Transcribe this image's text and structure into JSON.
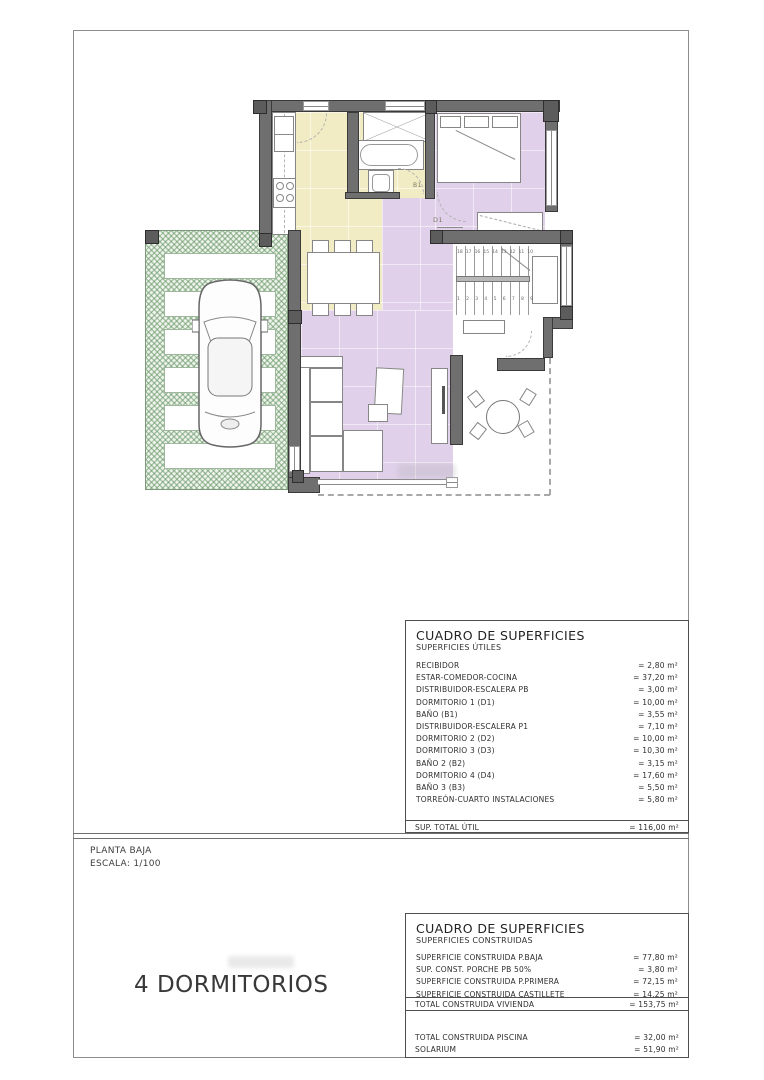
{
  "plan": {
    "labels": {
      "bath": "B1",
      "bedroom": "D1"
    },
    "stairs": {
      "top_numbers": [
        "18",
        "17",
        "16",
        "15",
        "14",
        "13",
        "12",
        "11",
        "10"
      ],
      "bottom_numbers": [
        "1",
        "2",
        "3",
        "4",
        "5",
        "6",
        "7",
        "8",
        "9"
      ]
    }
  },
  "caption": {
    "line1": "PLANTA BAJA",
    "line2": "ESCALA: 1/100"
  },
  "bedrooms_label": "4 DORMITORIOS",
  "tables": {
    "utiles": {
      "title": "CUADRO DE SUPERFICIES",
      "subtitle": "SUPERFICIES ÚTILES",
      "rows": [
        {
          "label": "RECIBIDOR",
          "value": "= 2,80 m²"
        },
        {
          "label": "ESTAR-COMEDOR-COCINA",
          "value": "= 37,20 m²"
        },
        {
          "label": "DISTRIBUIDOR-ESCALERA PB",
          "value": "= 3,00 m²"
        },
        {
          "label": "DORMITORIO 1 (D1)",
          "value": "= 10,00 m²"
        },
        {
          "label": "BAÑO (B1)",
          "value": "= 3,55 m²"
        },
        {
          "label": "DISTRIBUIDOR-ESCALERA P1",
          "value": "= 7,10 m²"
        },
        {
          "label": "DORMITORIO 2 (D2)",
          "value": "= 10,00 m²"
        },
        {
          "label": "DORMITORIO 3 (D3)",
          "value": "= 10,30 m²"
        },
        {
          "label": "BAÑO 2 (B2)",
          "value": "= 3,15 m²"
        },
        {
          "label": "DORMITORIO 4 (D4)",
          "value": "= 17,60 m²"
        },
        {
          "label": "BAÑO 3 (B3)",
          "value": "= 5,50 m²"
        },
        {
          "label": "TORREÓN-CUARTO INSTALACIONES",
          "value": "= 5,80 m²"
        }
      ],
      "total": {
        "label": "SUP. TOTAL ÚTIL",
        "value": "= 116,00 m²"
      }
    },
    "construidas": {
      "title": "CUADRO DE SUPERFICIES",
      "subtitle": "SUPERFICIES CONSTRUIDAS",
      "rows": [
        {
          "label": "SUPERFICIE CONSTRUIDA P.BAJA",
          "value": "= 77,80 m²"
        },
        {
          "label": "SUP. CONST. PORCHE PB 50%",
          "value": "= 3,80 m²"
        },
        {
          "label": "SUPERFICIE CONSTRUIDA P.PRIMERA",
          "value": "= 72,15 m²"
        },
        {
          "label": "SUPERFICIE CONSTRUIDA CASTILLETE",
          "value": "= 14,25 m²"
        }
      ],
      "total": {
        "label": "TOTAL CONSTRUIDA VIVIENDA",
        "value": "= 153,75 m²"
      },
      "extra_rows": [
        {
          "label": "TOTAL CONSTRUIDA PISCINA",
          "value": "= 32,00 m²"
        },
        {
          "label": "SOLARIUM",
          "value": "= 51,90 m²"
        }
      ]
    }
  },
  "colors": {
    "wall": "#6f6f6f",
    "room_purple": "#e0d0ea",
    "room_yellow": "#f1ecc3",
    "garden_green": "#6a9868",
    "table_line": "#4f4f4f"
  }
}
